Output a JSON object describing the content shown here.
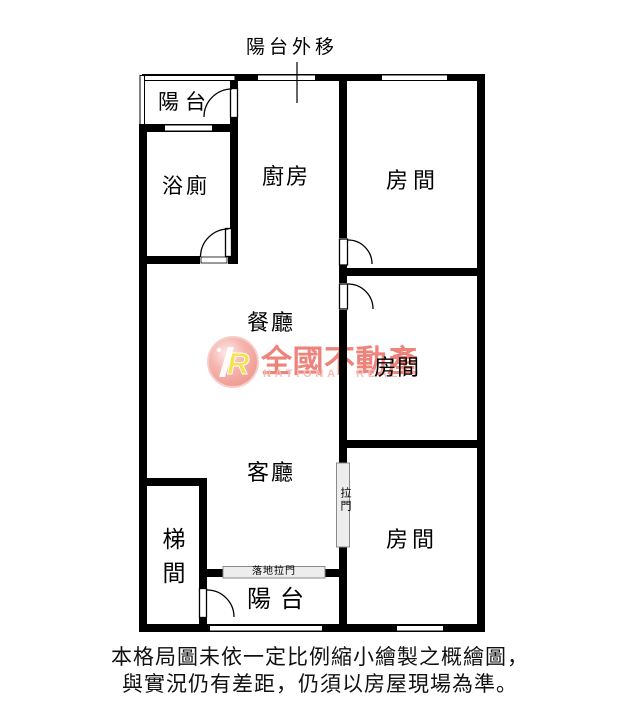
{
  "annotation": {
    "balcony_moved_out": "陽台外移"
  },
  "rooms": {
    "balcony_top": "陽台",
    "bathroom": "浴廁",
    "kitchen": "廚房",
    "bedroom_top": "房間",
    "dining": "餐廳",
    "bedroom_mid": "房間",
    "living": "客廳",
    "bedroom_bottom": "房間",
    "stairwell": "梯間",
    "balcony_bottom": "陽台"
  },
  "doors": {
    "sliding_door": "拉門",
    "floor_sliding_door": "落地拉門"
  },
  "watermark": {
    "logo_letter": "R",
    "brand": "全國不動產",
    "brand_en": "NATIONAL REALTY",
    "brand_color": "#ec7a71",
    "brand_en_color": "#f4b7b0",
    "logo_circle_color": "#f0958c"
  },
  "disclaimer": {
    "line1": "本格局圖未依一定比例縮小繪製之概繪圖，",
    "line2": "與實況仍有差距，仍須以房屋現場為準。"
  }
}
